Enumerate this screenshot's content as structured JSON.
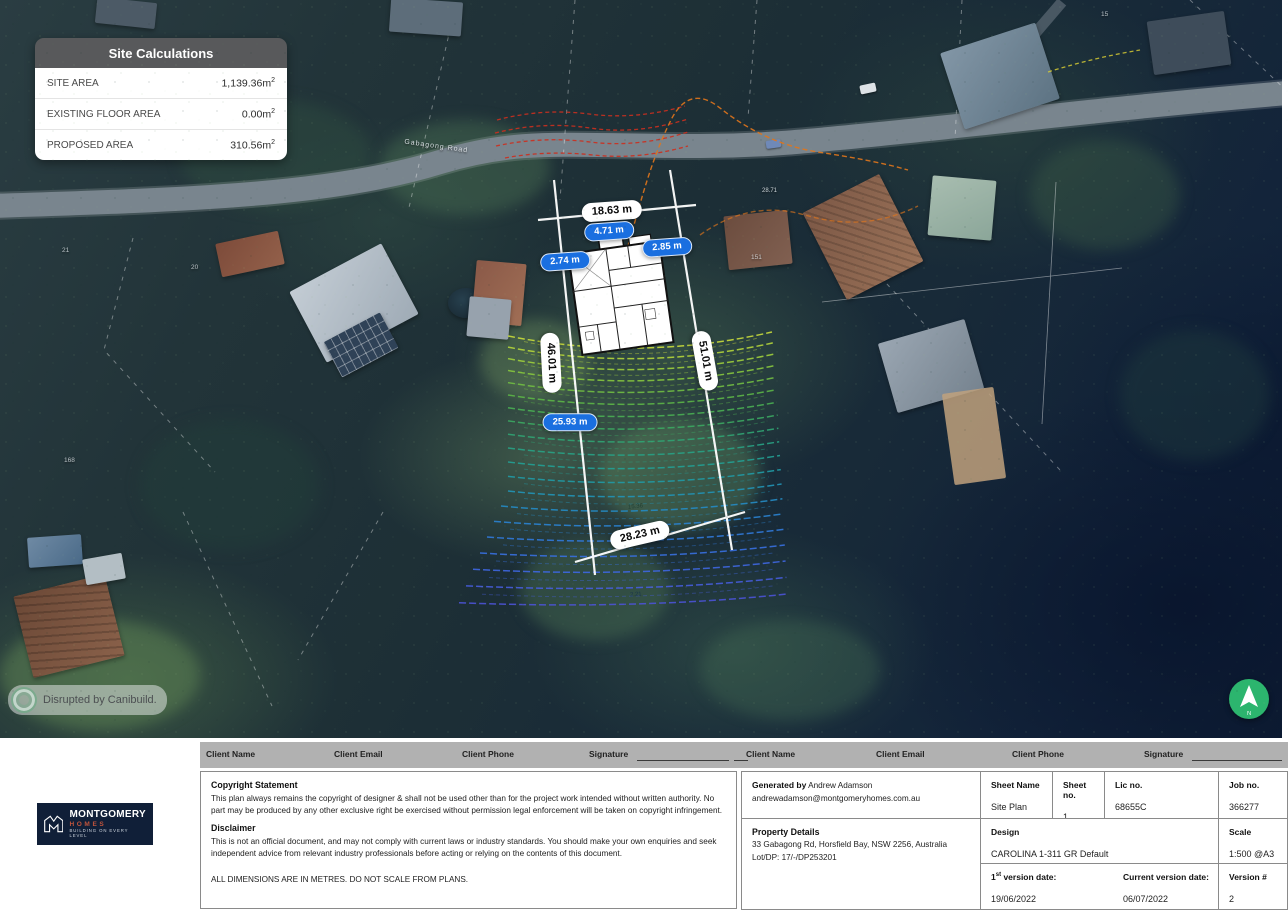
{
  "site_calculations": {
    "title": "Site Calculations",
    "rows": [
      {
        "label": "SITE AREA",
        "value": "1,139.36",
        "unit": "m",
        "sup": "2"
      },
      {
        "label": "EXISTING FLOOR AREA",
        "value": "0.00",
        "unit": "m",
        "sup": "2"
      },
      {
        "label": "PROPOSED AREA",
        "value": "310.56",
        "unit": "m",
        "sup": "2"
      }
    ]
  },
  "map": {
    "street": "Gabagong Road",
    "watermark": "Disrupted by Canibuild.",
    "north_letter": "N",
    "lot_labels": [
      {
        "text": "21"
      },
      {
        "text": "20"
      },
      {
        "text": "151"
      },
      {
        "text": "15"
      },
      {
        "text": "168"
      }
    ],
    "contour_labels": [
      {
        "text": "15.36"
      },
      {
        "text": "2.21"
      },
      {
        "text": "28.71"
      }
    ]
  },
  "pills": [
    {
      "label": "18.63 m",
      "type": "white"
    },
    {
      "label": "4.71 m",
      "type": "blue"
    },
    {
      "label": "2.85 m",
      "type": "blue"
    },
    {
      "label": "2.74 m",
      "type": "blue"
    },
    {
      "label": "46.01 m",
      "type": "white"
    },
    {
      "label": "51.01 m",
      "type": "white"
    },
    {
      "label": "25.93 m",
      "type": "blue"
    },
    {
      "label": "28.23 m",
      "type": "white"
    }
  ],
  "logo": {
    "name": "MONTGOMERY",
    "homes": "HOMES",
    "tagline": "BUILDING ON EVERY LEVEL"
  },
  "titleblock": {
    "header": {
      "client_name": "Client Name",
      "client_email": "Client Email",
      "client_phone": "Client Phone",
      "signature": "Signature"
    },
    "copyright_title": "Copyright Statement",
    "copyright_body": "This plan always remains the copyright of designer & shall not be used other than for the project work intended without written authority. No part may be produced by any other exclusive right be exercised without permission legal enforcement will be taken on copyright infringement.",
    "disclaimer_title": "Disclaimer",
    "disclaimer_body": "This is not an official document, and may not comply with current laws or industry standards. You should make your own enquiries and seek independent advice from relevant industry professionals before acting or relying on the contents of this document.",
    "dimensions_note": "ALL DIMENSIONS ARE IN METRES. DO NOT SCALE FROM PLANS.",
    "generated": {
      "label": "Generated by",
      "name": "Andrew Adamson",
      "email": "andrewadamson@montgomeryhomes.com.au"
    },
    "property": {
      "title": "Property Details",
      "address": "33 Gabagong Rd, Horsfield Bay, NSW 2256, Australia",
      "lot": "Lot/DP: 17/-/DP253201"
    },
    "sheet": {
      "name_label": "Sheet Name",
      "name": "Site Plan",
      "no_label": "Sheet no.",
      "no": "1",
      "lic_label": "Lic no.",
      "lic": "68655C",
      "job_label": "Job no.",
      "job": "366277"
    },
    "design": {
      "label": "Design",
      "value": "CAROLINA 1-311 GR Default"
    },
    "scale": {
      "label": "Scale",
      "value": "1:500 @A3"
    },
    "versions": {
      "first_pre": "1",
      "first_sup": "st",
      "first_post": "version date:",
      "first_value": "19/06/2022",
      "current_label": "Current version date:",
      "current_value": "06/07/2022",
      "num_label": "Version #",
      "num_value": "2"
    }
  },
  "colors": {
    "pill_blue": "#1a6fe0",
    "panel_header": "#58595b",
    "north_green": "#2cb56e",
    "logo_navy": "#101f38",
    "homes_red": "#c0543c"
  }
}
